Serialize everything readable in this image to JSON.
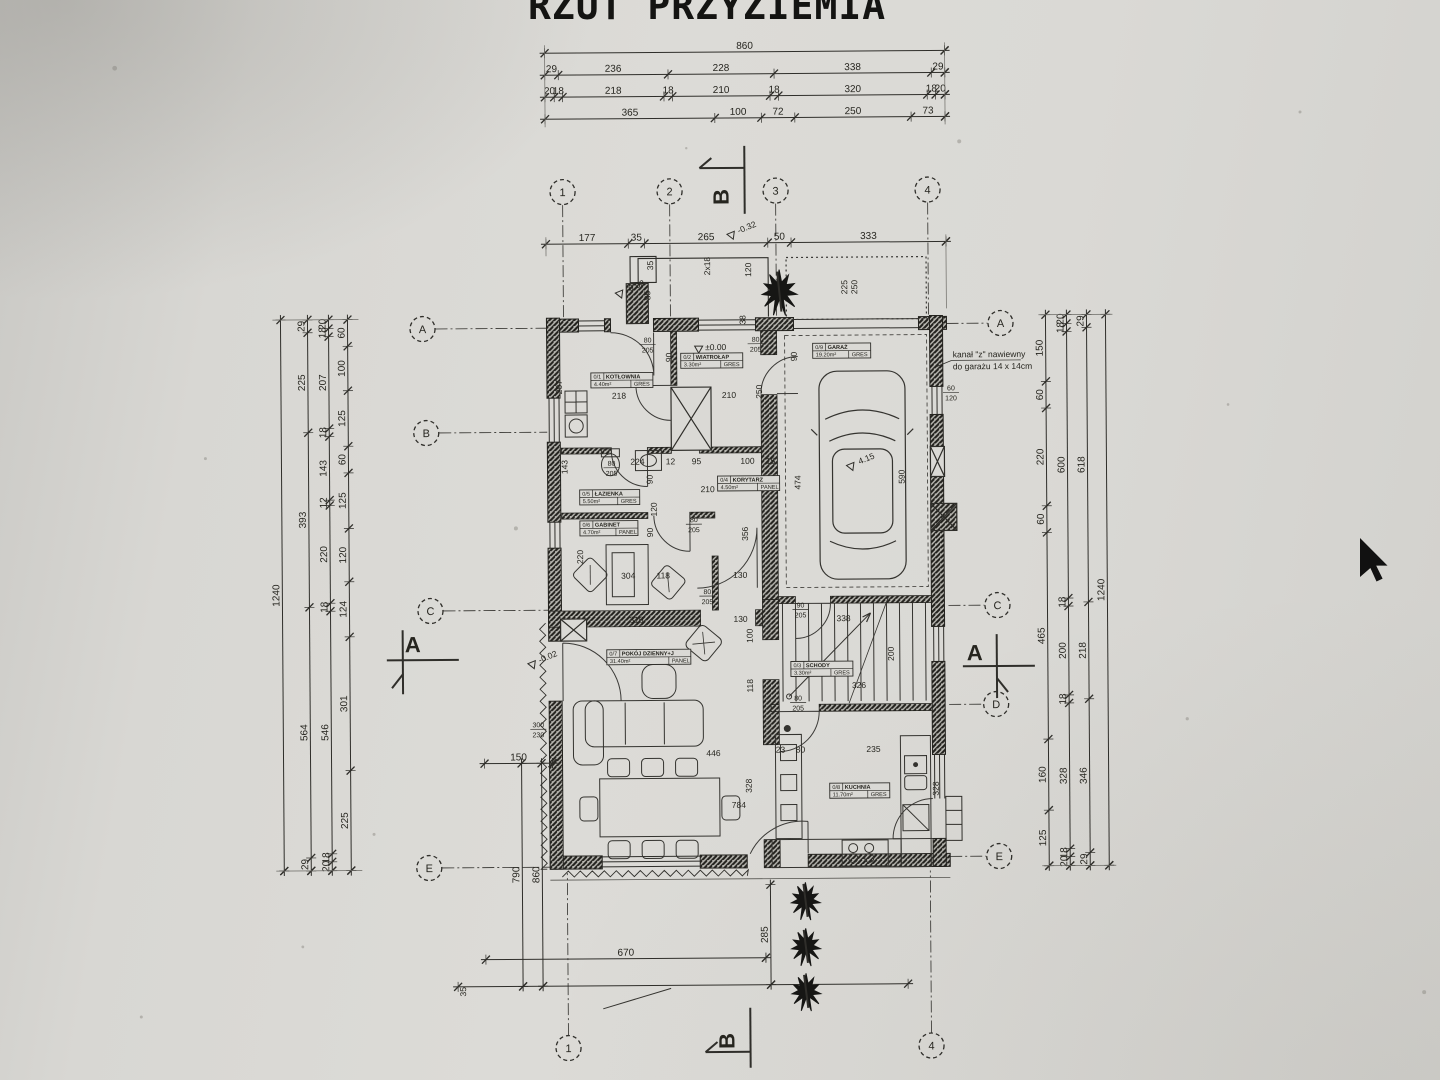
{
  "meta": {
    "title": "RZUT PRZYZIEMIA"
  },
  "colors": {
    "paper": "#dad9d5",
    "ink": "#2f2e2a",
    "wall": "#23221e",
    "cursor": "#111111"
  },
  "note": {
    "lines": [
      "kanał \"z\" nawiewny",
      "do garażu 14 x 14cm"
    ],
    "x": 954,
    "y": 359
  },
  "chains": [
    {
      "o": "h",
      "y": 52,
      "x0": 548,
      "x1": 948,
      "vals": [
        860
      ]
    },
    {
      "o": "h",
      "y": 74,
      "x0": 548,
      "x1": 948,
      "vals": [
        29,
        236,
        228,
        338,
        29
      ]
    },
    {
      "o": "h",
      "y": 96,
      "x0": 548,
      "x1": 948,
      "vals": [
        20,
        18,
        218,
        18,
        210,
        18,
        320,
        18,
        20
      ]
    },
    {
      "o": "h",
      "y": 118,
      "x0": 548,
      "x1": 948,
      "vals": [
        365,
        100,
        72,
        250,
        73
      ]
    },
    {
      "o": "h",
      "y": 243,
      "x0": 548,
      "x1": 948,
      "vals": [
        177,
        35,
        265,
        50,
        333
      ]
    },
    {
      "o": "v",
      "x": 282,
      "y0": 317,
      "y1": 868,
      "vals": [
        1240
      ]
    },
    {
      "o": "v",
      "x": 309,
      "y0": 317,
      "y1": 868,
      "vals": [
        29,
        225,
        393,
        564,
        29
      ]
    },
    {
      "o": "v",
      "x": 330,
      "y0": 317,
      "y1": 868,
      "vals": [
        20,
        18,
        207,
        18,
        143,
        12,
        220,
        18,
        546,
        18,
        20
      ]
    },
    {
      "o": "v",
      "x": 349,
      "y0": 317,
      "y1": 868,
      "vals": [
        60,
        100,
        125,
        60,
        125,
        120,
        124,
        301,
        225
      ]
    },
    {
      "o": "v",
      "x": 1047,
      "y0": 317,
      "y1": 868,
      "vals": [
        150,
        60,
        220,
        60,
        465,
        160,
        125
      ]
    },
    {
      "o": "v",
      "x": 1068,
      "y0": 317,
      "y1": 868,
      "vals": [
        20,
        18,
        600,
        18,
        200,
        18,
        328,
        18,
        20
      ]
    },
    {
      "o": "v",
      "x": 1088,
      "y0": 317,
      "y1": 868,
      "vals": [
        29,
        618,
        218,
        346,
        29
      ]
    },
    {
      "o": "v",
      "x": 1107,
      "y0": 317,
      "y1": 868,
      "vals": [
        1240
      ]
    },
    {
      "o": "h",
      "y": 762,
      "x0": 483,
      "x1": 551,
      "vals": [
        150
      ]
    },
    {
      "o": "h",
      "y": 958,
      "x0": 483,
      "x1": 763,
      "vals": [
        670
      ]
    },
    {
      "o": "h",
      "y": 985,
      "x0": 455,
      "x1": 905,
      "vals": []
    },
    {
      "o": "v",
      "x": 520,
      "y0": 762,
      "y1": 985,
      "vals": [
        790
      ]
    },
    {
      "o": "v",
      "x": 540,
      "y0": 762,
      "y1": 985,
      "vals": [
        860
      ]
    },
    {
      "o": "v",
      "x": 768,
      "y0": 885,
      "y1": 985,
      "vals": [
        285
      ]
    }
  ],
  "axes_top": [
    {
      "n": "1",
      "cx": 565,
      "cy": 191
    },
    {
      "n": "2",
      "cx": 672,
      "cy": 191
    },
    {
      "n": "3",
      "cx": 778,
      "cy": 191
    },
    {
      "n": "4",
      "cx": 930,
      "cy": 191
    }
  ],
  "axes_bottom": [
    {
      "n": "1",
      "cx": 565,
      "cy": 1047
    },
    {
      "n": "4",
      "cx": 928,
      "cy": 1047
    }
  ],
  "axes_left": [
    {
      "n": "A",
      "cx": 424,
      "cy": 327
    },
    {
      "n": "B",
      "cx": 427,
      "cy": 431
    },
    {
      "n": "C",
      "cx": 430,
      "cy": 609
    },
    {
      "n": "E",
      "cx": 427,
      "cy": 866
    }
  ],
  "axes_right": [
    {
      "n": "A",
      "cx": 1002,
      "cy": 325
    },
    {
      "n": "C",
      "cx": 997,
      "cy": 607
    },
    {
      "n": "D",
      "cx": 995,
      "cy": 706
    },
    {
      "n": "E",
      "cx": 997,
      "cy": 858
    }
  ],
  "sections": [
    {
      "t": "A",
      "lines": [
        [
          386,
          658,
          458,
          658
        ],
        [
          402,
          628,
          402,
          692
        ],
        [
          402,
          672,
          391,
          686
        ]
      ],
      "lx": 412,
      "ly": 650,
      "rot": 0
    },
    {
      "t": "A",
      "lines": [
        [
          962,
          668,
          1034,
          668
        ],
        [
          996,
          636,
          996,
          700
        ],
        [
          996,
          680,
          1007,
          694
        ]
      ],
      "lx": 974,
      "ly": 662,
      "rot": 0
    },
    {
      "t": "B",
      "lines": [
        [
          747,
          146,
          747,
          214
        ],
        [
          702,
          168,
          747,
          168
        ],
        [
          702,
          168,
          714,
          158
        ]
      ],
      "lx": 731,
      "ly": 197,
      "rot": -90
    },
    {
      "t": "B",
      "lines": [
        [
          747,
          1008,
          747,
          1068
        ],
        [
          702,
          1052,
          747,
          1052
        ],
        [
          702,
          1052,
          714,
          1042
        ]
      ],
      "lx": 731,
      "ly": 1041,
      "rot": -90
    }
  ],
  "dims": [
    [
      652,
      295,
      1,
      "85"
    ],
    [
      655,
      265,
      1,
      "35"
    ],
    [
      712,
      266,
      1,
      "2x18"
    ],
    [
      753,
      270,
      1,
      "120"
    ],
    [
      747,
      320,
      1,
      "38"
    ],
    [
      849,
      288,
      1,
      "225"
    ],
    [
      859,
      288,
      1,
      "250"
    ],
    [
      563,
      386,
      1,
      "207"
    ],
    [
      673,
      357,
      1,
      "90"
    ],
    [
      620,
      398,
      0,
      "218"
    ],
    [
      730,
      398,
      0,
      "210"
    ],
    [
      763,
      392,
      1,
      "250"
    ],
    [
      798,
      357,
      1,
      "90"
    ],
    [
      801,
      483,
      1,
      "474"
    ],
    [
      905,
      478,
      1,
      "590"
    ],
    [
      638,
      464,
      0,
      "224"
    ],
    [
      671,
      464,
      0,
      "12"
    ],
    [
      697,
      464,
      0,
      "95"
    ],
    [
      748,
      464,
      0,
      "100"
    ],
    [
      771,
      464,
      0,
      "15"
    ],
    [
      568,
      466,
      1,
      "143"
    ],
    [
      653,
      479,
      1,
      "90"
    ],
    [
      708,
      492,
      0,
      "210"
    ],
    [
      657,
      509,
      1,
      "120"
    ],
    [
      653,
      532,
      1,
      "90"
    ],
    [
      748,
      534,
      1,
      "356"
    ],
    [
      583,
      556,
      1,
      "220"
    ],
    [
      628,
      578,
      0,
      "304"
    ],
    [
      663,
      578,
      0,
      "118"
    ],
    [
      740,
      578,
      0,
      "130"
    ],
    [
      636,
      622,
      0,
      "316"
    ],
    [
      740,
      622,
      0,
      "130"
    ],
    [
      752,
      636,
      1,
      "100"
    ],
    [
      752,
      686,
      1,
      "118"
    ],
    [
      843,
      622,
      0,
      "338"
    ],
    [
      893,
      655,
      1,
      "200"
    ],
    [
      858,
      689,
      0,
      "326"
    ],
    [
      712,
      756,
      0,
      "446"
    ],
    [
      779,
      753,
      0,
      "23"
    ],
    [
      799,
      753,
      0,
      "80"
    ],
    [
      872,
      753,
      0,
      "235"
    ],
    [
      750,
      786,
      1,
      "328"
    ],
    [
      937,
      790,
      1,
      "328"
    ],
    [
      737,
      808,
      0,
      "784"
    ],
    [
      463,
      990,
      1,
      "35"
    ]
  ],
  "fracs": [
    [
      649,
      342,
      "80",
      "205"
    ],
    [
      757,
      342,
      "80",
      "205"
    ],
    [
      612,
      465,
      "80",
      "205"
    ],
    [
      694,
      522,
      "80",
      "205"
    ],
    [
      707,
      594,
      "80",
      "205"
    ],
    [
      797,
      701,
      "80",
      "205"
    ],
    [
      800,
      608,
      "90",
      "205"
    ],
    [
      952,
      392,
      "60",
      "120"
    ],
    [
      537,
      726,
      "300",
      "230"
    ]
  ],
  "levels": [
    {
      "x": 732,
      "y": 231,
      "rot": -22,
      "t": "-0.32"
    },
    {
      "x": 620,
      "y": 289,
      "rot": -22,
      "t": "-0.02"
    },
    {
      "x": 700,
      "y": 344,
      "rot": 0,
      "t": "±0.00"
    },
    {
      "x": 530,
      "y": 659,
      "rot": -22,
      "t": "-0.02"
    },
    {
      "x": 850,
      "y": 463,
      "rot": -22,
      "t": "4.15"
    }
  ],
  "rooms": [
    {
      "num": "0/1",
      "name": "KOTŁOWNIA",
      "area": "4.40m²",
      "floor": "GRES",
      "x": 592,
      "y": 372,
      "w": 62
    },
    {
      "num": "0/2",
      "name": "WIATROŁAP",
      "area": "3.30m²",
      "floor": "GRES",
      "x": 682,
      "y": 353,
      "w": 62
    },
    {
      "num": "0/3",
      "name": "SCHODY",
      "area": "3.30m²",
      "floor": "GRES",
      "x": 790,
      "y": 662,
      "w": 62
    },
    {
      "num": "0/4",
      "name": "KORYTARZ",
      "area": "4.50m²",
      "floor": "PANEL",
      "x": 718,
      "y": 476,
      "w": 62
    },
    {
      "num": "0/5",
      "name": "ŁAZIENKA",
      "area": "5.50m²",
      "floor": "GRES",
      "x": 580,
      "y": 489,
      "w": 60
    },
    {
      "num": "0/6",
      "name": "GABINET",
      "area": "4.70m²",
      "floor": "PANEL",
      "x": 580,
      "y": 520,
      "w": 58
    },
    {
      "num": "0/7",
      "name": "POKÓJ DZIENNY+J",
      "area": "31.40m²",
      "floor": "PANEL",
      "x": 606,
      "y": 649,
      "w": 84
    },
    {
      "num": "0/8",
      "name": "KUCHNIA",
      "area": "11.70m²",
      "floor": "GRES",
      "x": 828,
      "y": 784,
      "w": 60
    },
    {
      "num": "0/9",
      "name": "GARAŻ",
      "area": "19.20m²",
      "floor": "GRES",
      "x": 814,
      "y": 344,
      "w": 58
    }
  ],
  "trees": [
    {
      "x": 781,
      "y": 292,
      "s": 40
    },
    {
      "x": 803,
      "y": 901,
      "s": 33
    },
    {
      "x": 803,
      "y": 947,
      "s": 33
    },
    {
      "x": 803,
      "y": 992,
      "s": 33
    }
  ],
  "cursor": {
    "x": 1360,
    "y": 538
  }
}
